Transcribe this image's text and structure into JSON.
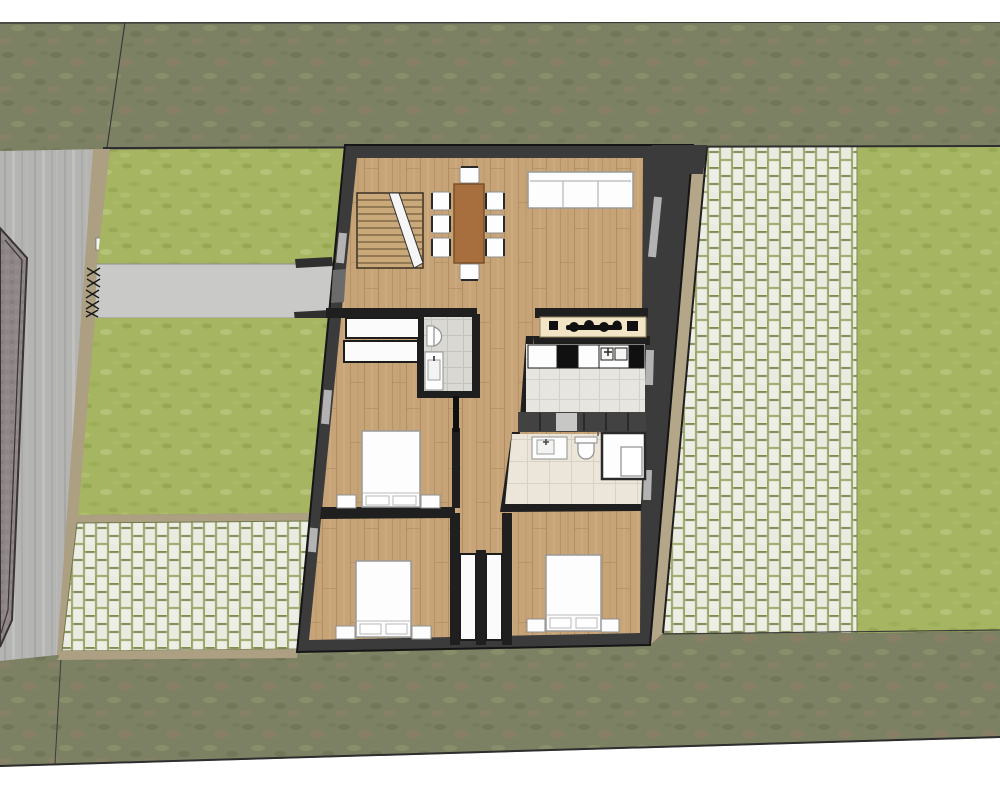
{
  "scene": {
    "kind": "architectural-floor-plan-render",
    "view": "top-down-site-plan",
    "rooms": [
      {
        "name": "living-dining-room",
        "floor": "wood"
      },
      {
        "name": "bathroom-1",
        "floor": "gray-tile"
      },
      {
        "name": "kitchen",
        "floor": "light-tile"
      },
      {
        "name": "bathroom-2",
        "floor": "beige-tile"
      },
      {
        "name": "bedroom-1",
        "floor": "wood"
      },
      {
        "name": "bedroom-2",
        "floor": "wood"
      },
      {
        "name": "bedroom-3",
        "floor": "wood"
      },
      {
        "name": "hallway",
        "floor": "wood"
      }
    ],
    "furniture": {
      "living_dining": [
        "staircase",
        "dining-table",
        "dining-chairs-x8",
        "sofa-3-seat"
      ],
      "bathroom_1": [
        "toilet",
        "washbasin"
      ],
      "kitchen": [
        "cooktop-counter",
        "cabinet-row",
        "double-sink",
        "oven",
        "fridge"
      ],
      "utility": [
        "dark-cabinet-row",
        "washer"
      ],
      "bathroom_2": [
        "washbasin",
        "toilet",
        "shower-enclosure"
      ],
      "bedroom_1": [
        "double-bed",
        "nightstand-x2",
        "wardrobe-x2"
      ],
      "bedroom_2": [
        "double-bed",
        "nightstand-x2"
      ],
      "bedroom_3": [
        "double-bed",
        "nightstand-x2"
      ],
      "hall_closets": [
        "closet-x2"
      ]
    },
    "site": [
      "perimeter-rough-grass",
      "street-left",
      "neighbor-cobble-corner",
      "tan-fence-line",
      "front-lawn-upper",
      "entry-walkway",
      "entry-gate-hatch",
      "front-lawn-lower",
      "front-paver-court",
      "side-tan-wedge",
      "right-paver-path",
      "backyard-lawn"
    ]
  },
  "palette": {
    "page_bg": "#ffffff",
    "rough_grass": "#7d8164",
    "rough_spot_dark": "#6d7354",
    "rough_spot_brown": "#8d8166",
    "rough_spot_light": "#8b906c",
    "lawn": "#a5b562",
    "lawn_dark": "#95a74f",
    "lawn_light": "#b6c579",
    "road": "#b4b4b2",
    "road_streak_dark": "#a6a6a4",
    "road_streak_light": "#c1c1bf",
    "cobble": "#8e8687",
    "cobble_line": "#3a3436",
    "fence": "#ac9f82",
    "walkway": "#c9c9c7",
    "wedge": "#b4a789",
    "paver_grout": "#98a45c",
    "paver_brick": "#edeee6",
    "paver_speck": "#5a6443",
    "boundary": "#2e2e2e",
    "wall": "#3b3b3b",
    "wall_edge": "#151515",
    "partition": "#1f1f1f",
    "wood": "#c6a477",
    "wood_line": "#ab8a5c",
    "tile_gray": "#dad8d3",
    "tile_gray_line": "#c5c3be",
    "tile_kitchen": "#e7e5e0",
    "tile_kitchen_line": "#d3d1cc",
    "tile_beige": "#ece6da",
    "tile_beige_line": "#d9d2c2",
    "fixture_white": "#fdfdfd",
    "fixture_line": "#8f8f8f",
    "counter": "#f1e5c5",
    "counter_line": "#90825c",
    "cabinet": "#424242",
    "cabinet_light": "#c7c7c5",
    "appliance_black": "#101010",
    "table": "#a76f3e",
    "table_line": "#7c5128",
    "door_leaf": "#0f0f0f",
    "window": "#b3b3b3",
    "closet_white": "#fbfbfb"
  }
}
